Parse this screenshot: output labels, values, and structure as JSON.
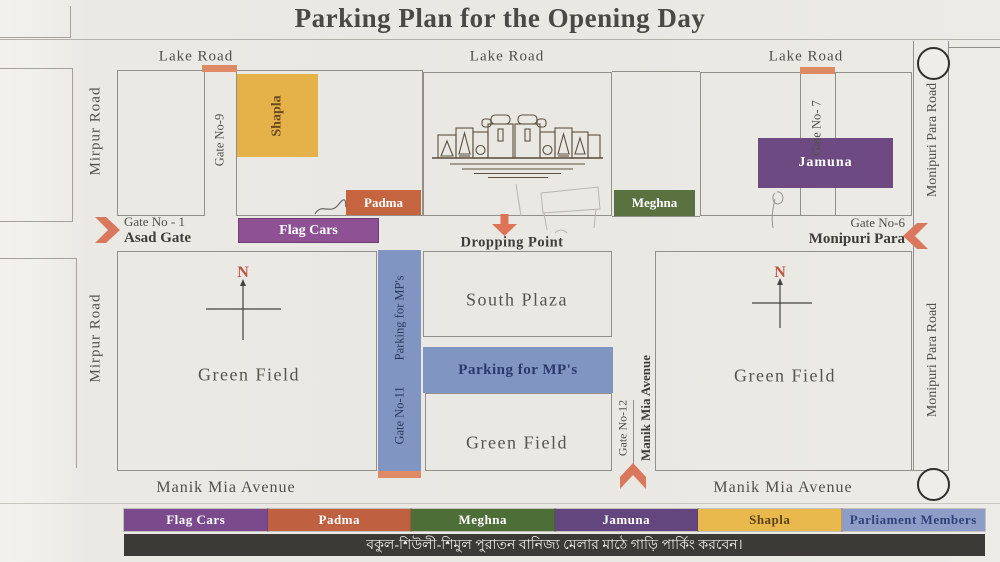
{
  "title": "Parking Plan for the Opening Day",
  "roads": {
    "lake_road": "Lake Road",
    "mirpur_road": "Mirpur Road",
    "monipuri_para_road": "Monipuri Para Road",
    "manik_mia_avenue": "Manik Mia Avenue"
  },
  "gates": {
    "gate_1_label": "Gate No - 1",
    "gate_1_name": "Asad Gate",
    "gate_6_label": "Gate No-6",
    "gate_6_name": "Monipuri Para",
    "gate_7_label": "Gate No- 7",
    "gate_9_label": "Gate No-9",
    "gate_11_label": "Gate No-11",
    "gate_12_label": "Gate No-12"
  },
  "zones": {
    "shapla": "Shapla",
    "padma": "Padma",
    "meghna": "Meghna",
    "jamuna": "Jamuna",
    "flag_cars": "Flag Cars",
    "parking_mps": "Parking for MP's"
  },
  "labels": {
    "dropping_point": "Dropping Point",
    "south_plaza": "South Plaza",
    "green_field": "Green Field",
    "compass_n": "N"
  },
  "legend": {
    "items": [
      {
        "label": "Flag Cars",
        "color": "#7b4a8c",
        "text": "#ffffff"
      },
      {
        "label": "Padma",
        "color": "#bf6140",
        "text": "#ffffff"
      },
      {
        "label": "Meghna",
        "color": "#4e6e38",
        "text": "#ffffff"
      },
      {
        "label": "Jamuna",
        "color": "#64467e",
        "text": "#ffffff"
      },
      {
        "label": "Shapla",
        "color": "#eab94d",
        "text": "#5d4418"
      },
      {
        "label": "Parliament Members",
        "color": "#8d9dc8",
        "text": "#31417a"
      }
    ]
  },
  "notice": {
    "text_bn": "বকুল-শিউলী-শিমুল পুরাতন বানিজ্য মেলার মাঠে গাড়ি পার্কিং করবেন।"
  },
  "colors": {
    "paper": "#eae9e4",
    "map_line": "#918f88",
    "ink": "#4b4945",
    "shapla_box": "#e5b149",
    "padma_box": "#c4653f",
    "meghna_box": "#5a7240",
    "jamuna_box": "#6d4b82",
    "flag_cars_box": "#8d5194",
    "mp_blue": "#8095c2",
    "gate_tick": "#dd8a65",
    "arrow_red": "#d9785c",
    "notice_bar": "#3b3a37"
  }
}
